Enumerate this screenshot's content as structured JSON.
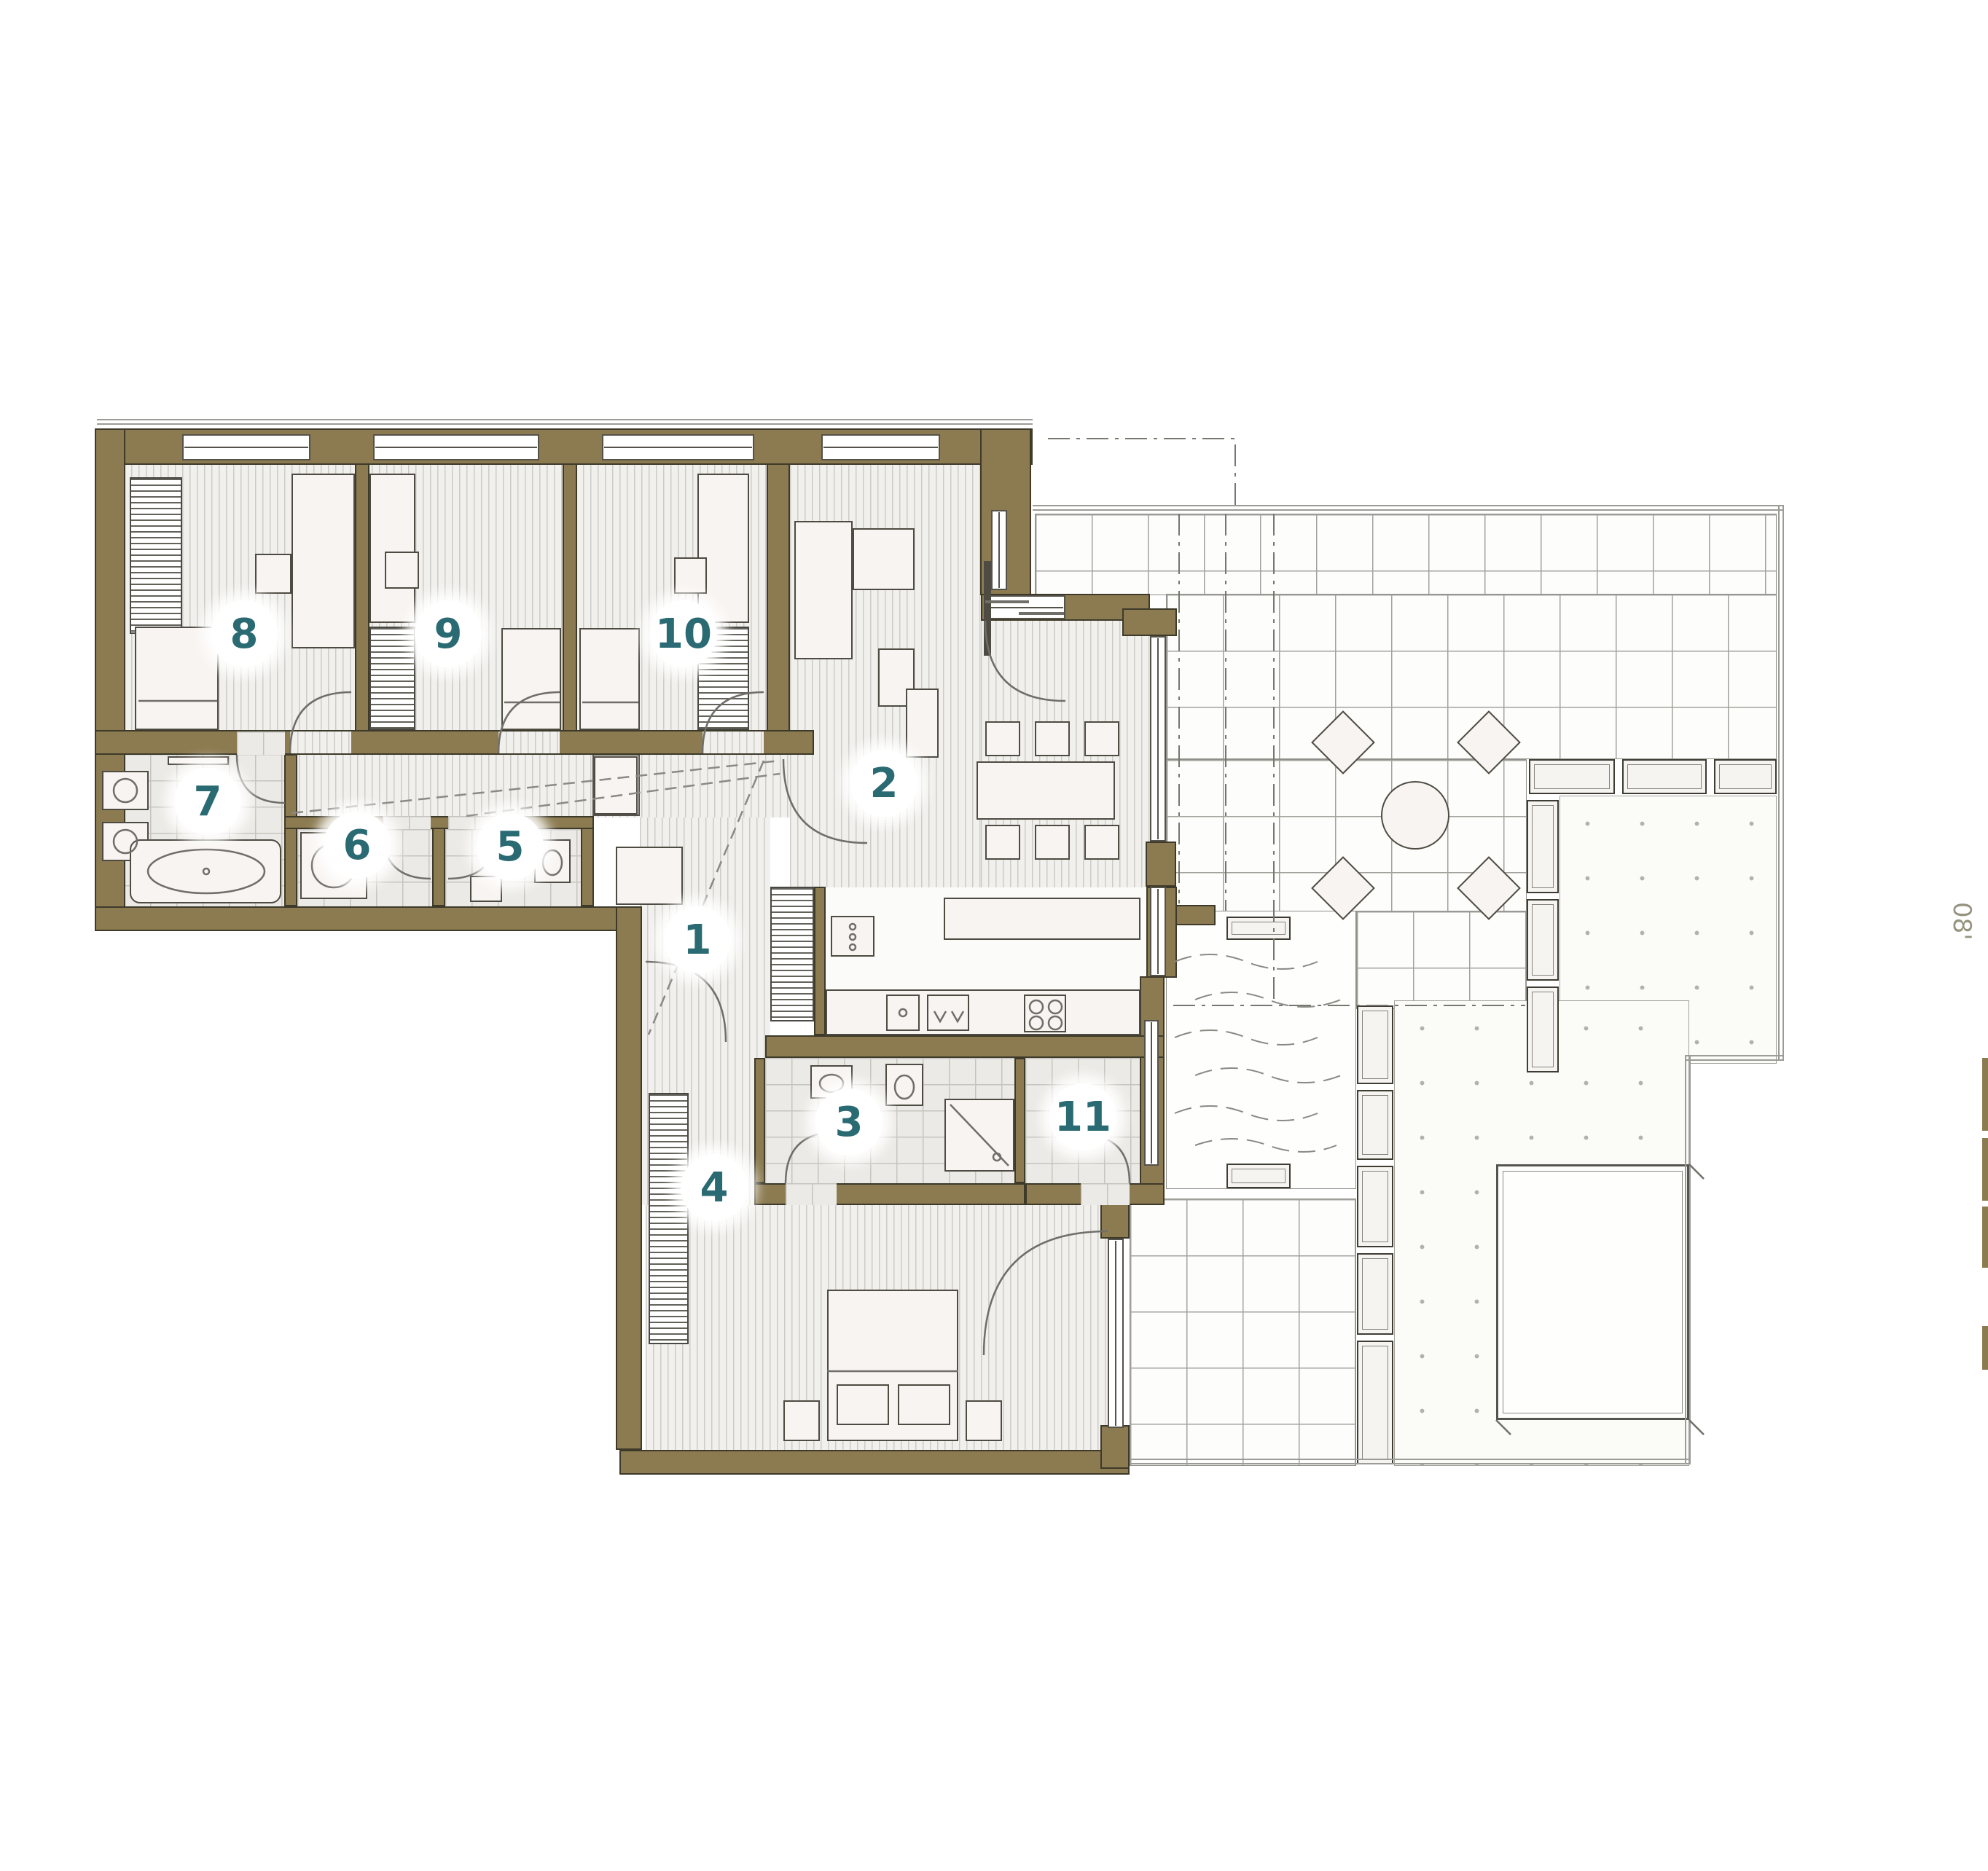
{
  "rooms": [
    {
      "number": "1"
    },
    {
      "number": "2"
    },
    {
      "number": "3"
    },
    {
      "number": "4"
    },
    {
      "number": "5"
    },
    {
      "number": "6"
    },
    {
      "number": "7"
    },
    {
      "number": "8"
    },
    {
      "number": "9"
    },
    {
      "number": "10"
    },
    {
      "number": "11"
    }
  ],
  "annotations": {
    "dim_right": "08'"
  },
  "colors": {
    "wall": "#8c7b51",
    "label_teal": "#2a6a72",
    "floor": "#f1f0ed",
    "tile": "#eceae6"
  }
}
